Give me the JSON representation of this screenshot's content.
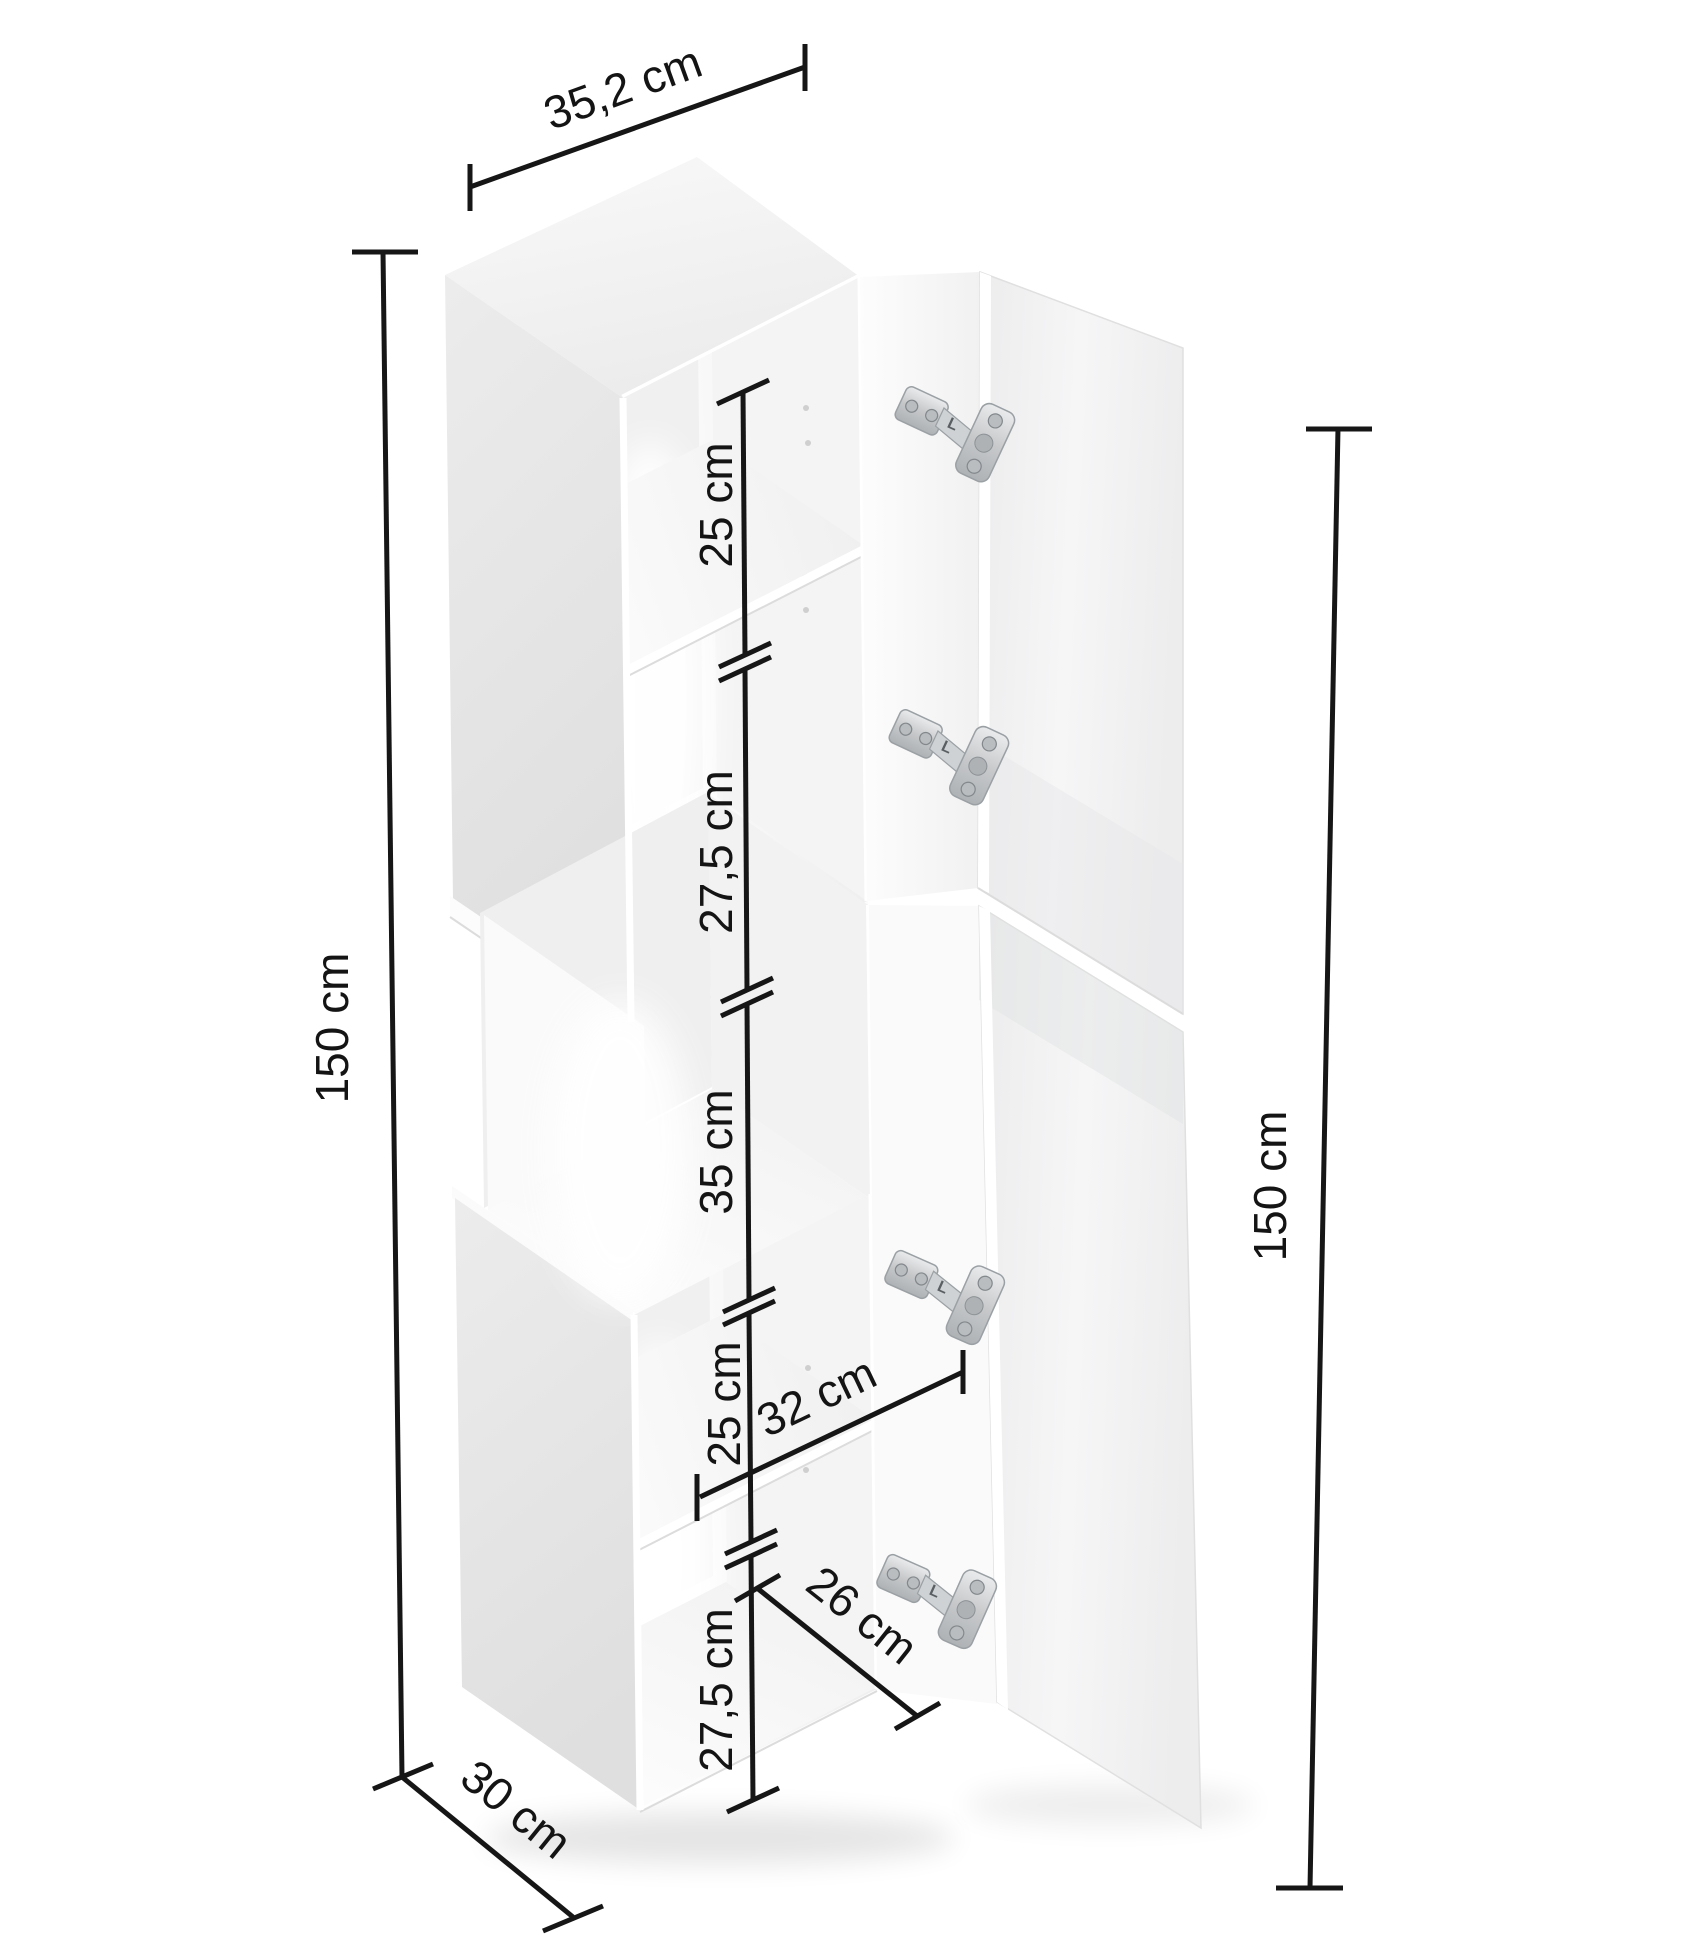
{
  "diagram": {
    "dimensions": {
      "width_top": "35,2 cm",
      "height_left": "150 cm",
      "height_right": "150 cm",
      "depth_bottom": "30 cm",
      "inner_width": "32 cm",
      "inner_bottom_width": "26 cm",
      "compartments": [
        "25 cm",
        "27,5 cm",
        "35 cm",
        "25 cm",
        "27,5 cm"
      ]
    },
    "hinge_marking": "L",
    "colors": {
      "dimension_line": "#161616",
      "cabinet_side": "#e6e6e6",
      "cabinet_top": "#f2f2f2",
      "cabinet_interior": "#fcfcfc",
      "door_face": "#f0f1f2",
      "hinge_metal": "#c6c8ca"
    }
  }
}
